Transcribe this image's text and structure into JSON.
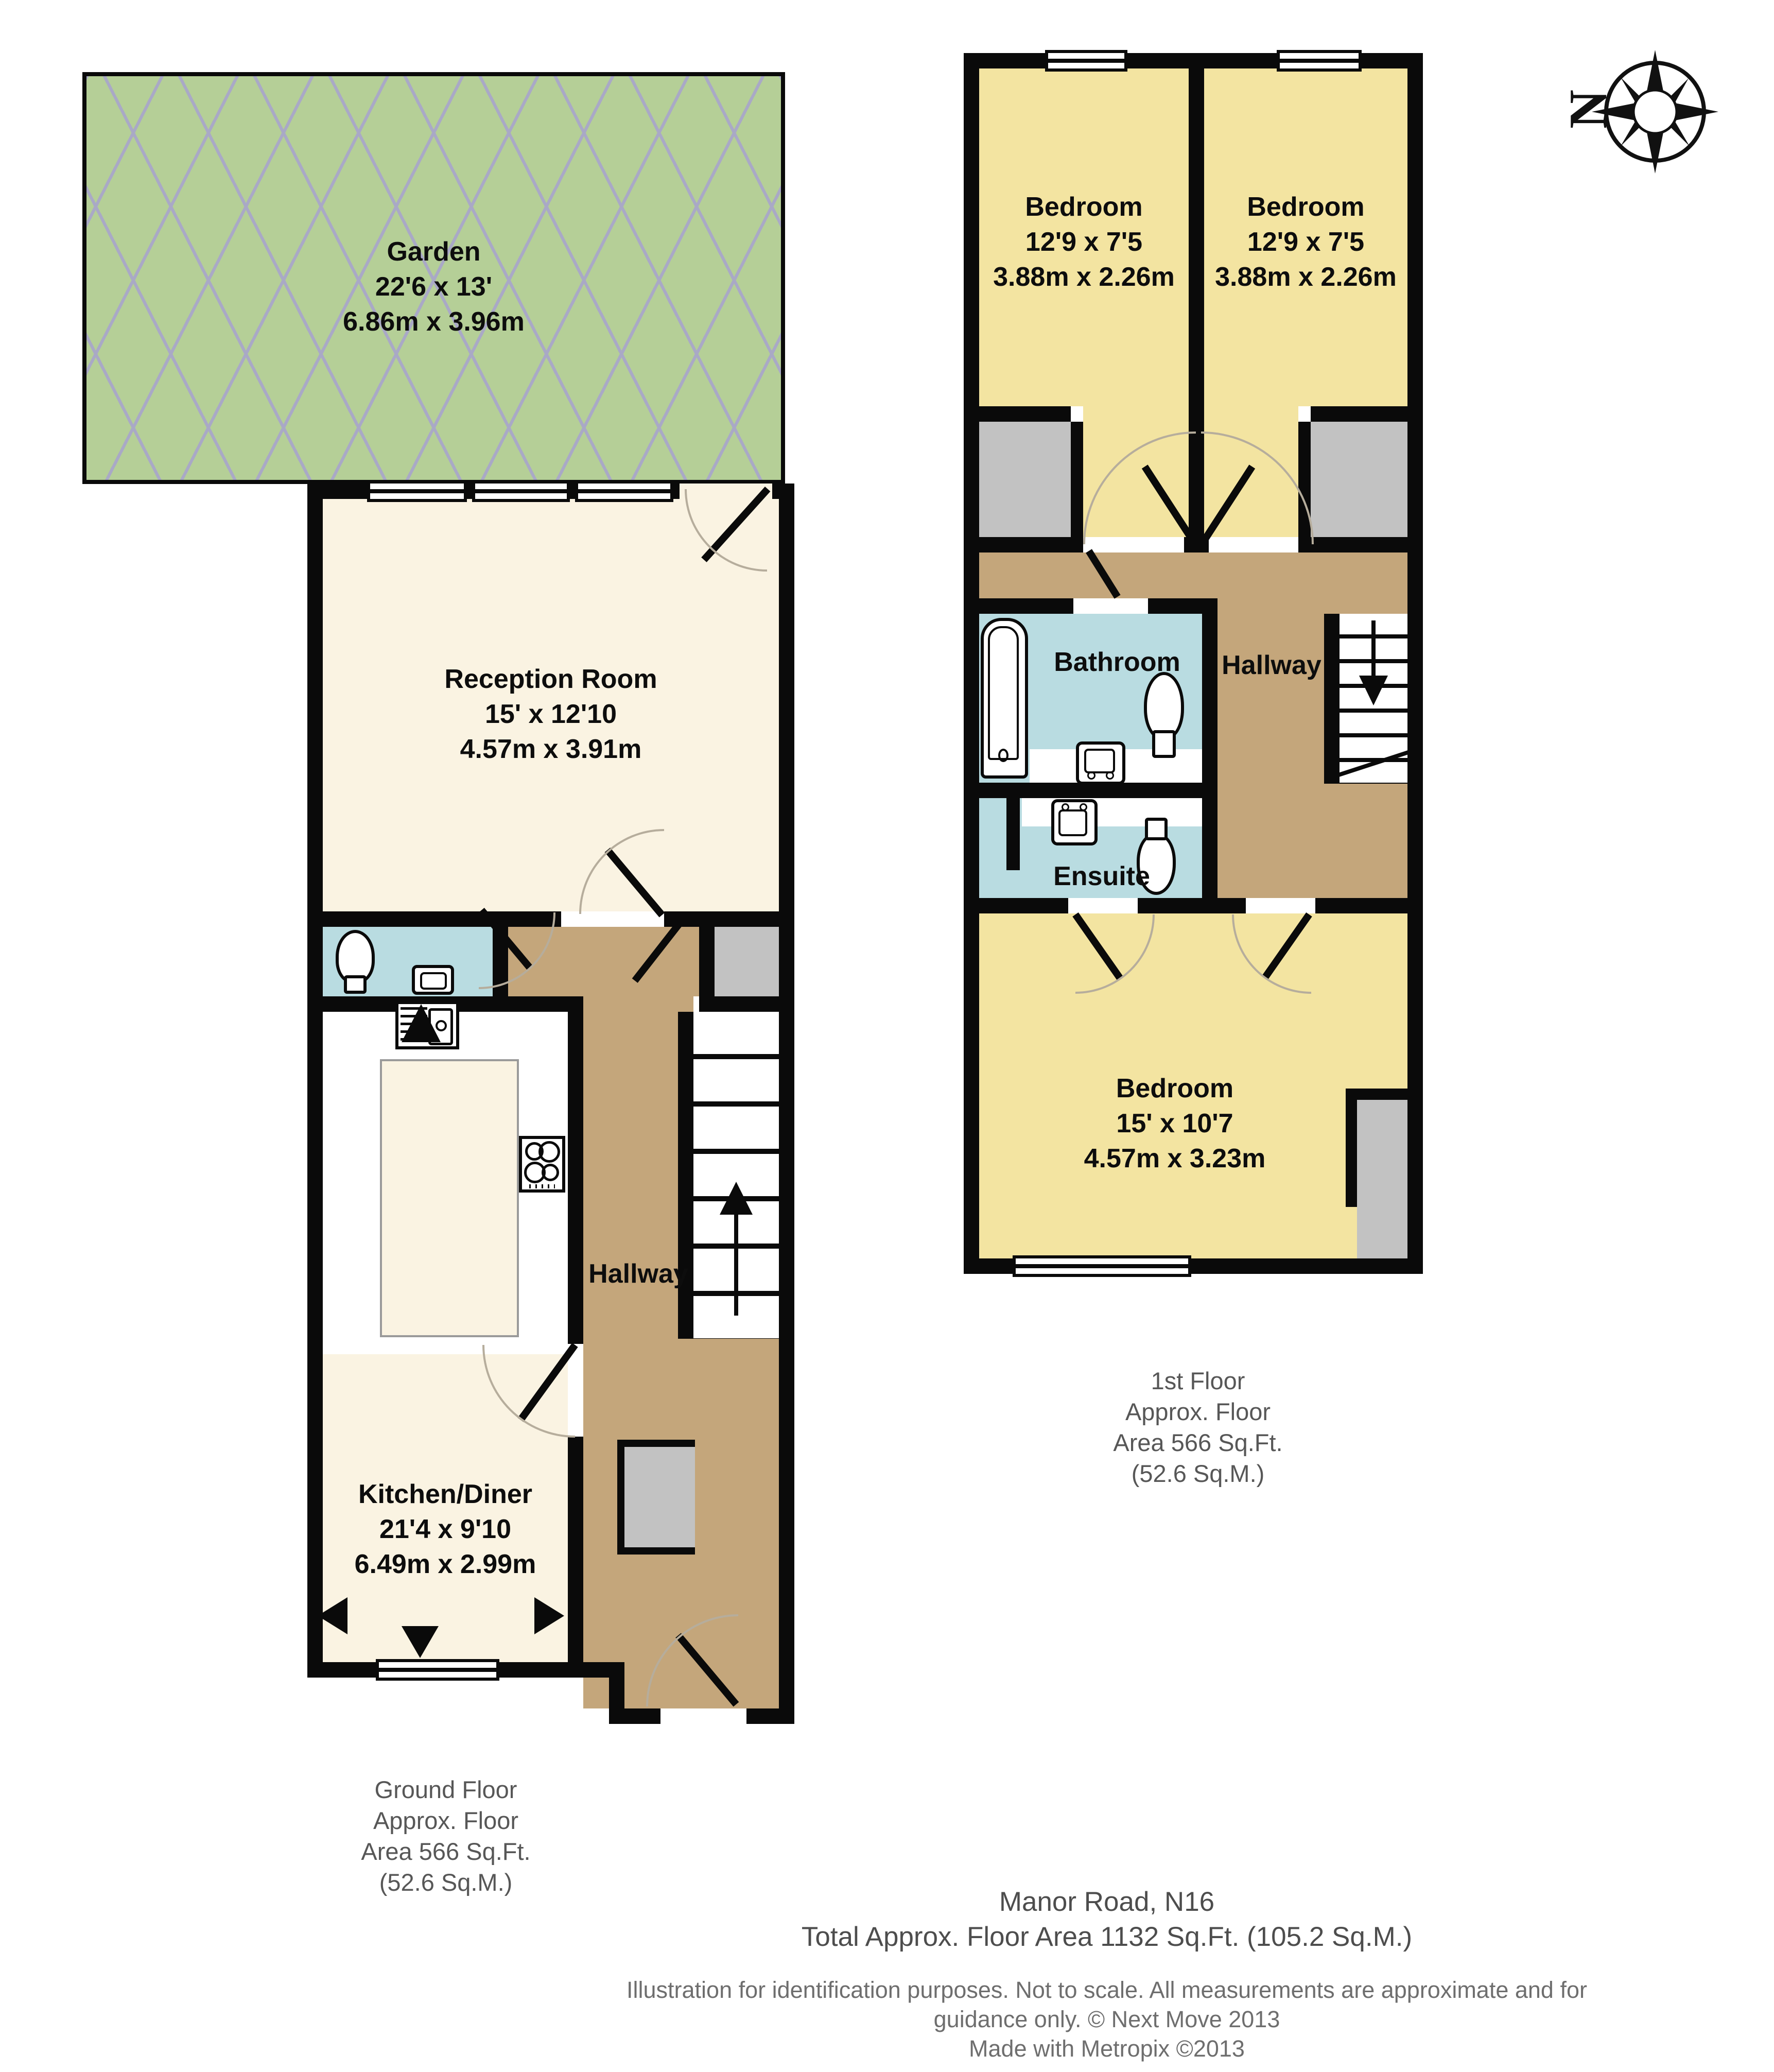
{
  "colors": {
    "garden_green": "#b5cf97",
    "lattice_line": "#a9a9c6",
    "room_cream": "#faf3e2",
    "bedroom_yellow": "#f3e4a1",
    "bath_blue": "#b9dce1",
    "hallway_brown": "#c4a67b",
    "closet_gray": "#c2c2c2",
    "wall_black": "#0a0a0a"
  },
  "icons": {
    "compass": "compass-rose-north-left",
    "stairs_up_arrow": "▲",
    "stairs_down_arrow": "▼",
    "opening_arrow_left": "◄",
    "opening_arrow_right": "►",
    "window_arrow_down": "▼"
  },
  "ground_floor": {
    "garden": {
      "name": "Garden",
      "dims_imperial": "22'6 x 13'",
      "dims_metric": "6.86m x 3.96m"
    },
    "reception": {
      "name": "Reception Room",
      "dims_imperial": "15' x 12'10",
      "dims_metric": "4.57m x 3.91m"
    },
    "kitchen": {
      "name": "Kitchen/Diner",
      "dims_imperial": "21'4 x 9'10",
      "dims_metric": "6.49m x 2.99m"
    },
    "hallway": {
      "name": "Hallway"
    },
    "caption": [
      "Ground Floor",
      "Approx. Floor",
      "Area 566 Sq.Ft.",
      "(52.6 Sq.M.)"
    ]
  },
  "first_floor": {
    "bedroom_left": {
      "name": "Bedroom",
      "dims_imperial": "12'9 x 7'5",
      "dims_metric": "3.88m x 2.26m"
    },
    "bedroom_right": {
      "name": "Bedroom",
      "dims_imperial": "12'9 x 7'5",
      "dims_metric": "3.88m x 2.26m"
    },
    "bathroom": {
      "name": "Bathroom"
    },
    "ensuite": {
      "name": "Ensuite"
    },
    "hallway": {
      "name": "Hallway"
    },
    "bedroom_main": {
      "name": "Bedroom",
      "dims_imperial": "15' x 10'7",
      "dims_metric": "4.57m x 3.23m"
    },
    "caption": [
      "1st Floor",
      "Approx. Floor",
      "Area 566 Sq.Ft.",
      "(52.6 Sq.M.)"
    ]
  },
  "footer": {
    "address": "Manor Road, N16",
    "total_area": "Total Approx. Floor Area 1132 Sq.Ft. (105.2 Sq.M.)",
    "disclaimer": [
      "Illustration for identification purposes. Not to scale. All measurements are approximate and for",
      "guidance only. © Next Move 2013",
      "Made with Metropix ©2013"
    ]
  },
  "compass": {
    "north_label": "N"
  }
}
